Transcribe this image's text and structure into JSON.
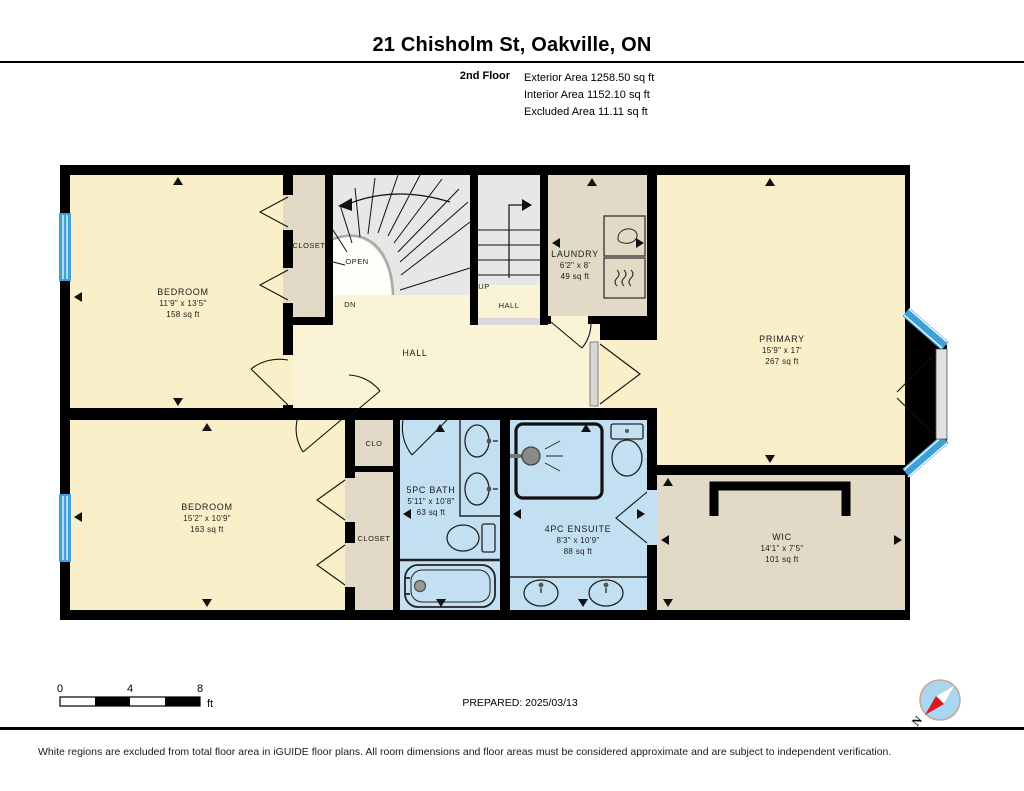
{
  "header": {
    "title": "21 Chisholm St, Oakville, ON",
    "floor_label": "2nd Floor",
    "area_lines": [
      "Exterior Area 1258.50 sq ft",
      "Interior Area 1152.10 sq ft",
      "Excluded Area 11.11 sq ft"
    ]
  },
  "rooms": {
    "bedroom_tl": {
      "name": "BEDROOM",
      "dims": "11'9\" x 13'5\"",
      "area": "158 sq ft"
    },
    "closet_tl": {
      "name": "CLOSET"
    },
    "open_area": {
      "name": "OPEN"
    },
    "dn": {
      "name": "DN"
    },
    "up": {
      "name": "UP"
    },
    "hall_upper": {
      "name": "HALL"
    },
    "laundry": {
      "name": "LAUNDRY",
      "dims": "6'2\" x 8'",
      "area": "49 sq ft"
    },
    "primary": {
      "name": "PRIMARY",
      "dims": "15'9\" x 17'",
      "area": "267 sq ft"
    },
    "hall": {
      "name": "HALL"
    },
    "bedroom_bl": {
      "name": "BEDROOM",
      "dims": "15'2\" x 10'9\"",
      "area": "163 sq ft"
    },
    "clo": {
      "name": "CLO"
    },
    "closet_bl": {
      "name": "CLOSET"
    },
    "bath": {
      "name": "5PC BATH",
      "dims": "5'11\" x 10'8\"",
      "area": "63 sq ft"
    },
    "ensuite": {
      "name": "4PC ENSUITE",
      "dims": "8'3\" x 10'9\"",
      "area": "88 sq ft"
    },
    "wic": {
      "name": "WIC",
      "dims": "14'1\" x 7'5\"",
      "area": "101 sq ft"
    }
  },
  "scalebar": {
    "ticks": [
      "0",
      "4",
      "8"
    ],
    "unit": "ft"
  },
  "plan_footer": {
    "prepared": "PREPARED: 2025/03/13"
  },
  "compass": {
    "north_label": "N"
  },
  "footer": {
    "disclaimer": "White regions are excluded from total floor area in iGUIDE floor plans. All room dimensions and floor areas must be considered approximate and are subject to independent verification."
  },
  "colors": {
    "wall": "#000000",
    "room_cream": "#F9EFC8",
    "hall_cream": "#FBF3D6",
    "closet_tan": "#E2DAC6",
    "bath_blue": "#C2E0F2",
    "window_blue": "#3FA0D6",
    "stair_gray": "#E7E7E5",
    "compass_fill": "#A9D6F0",
    "compass_ring": "#C9A896",
    "compass_red": "#D91820"
  }
}
